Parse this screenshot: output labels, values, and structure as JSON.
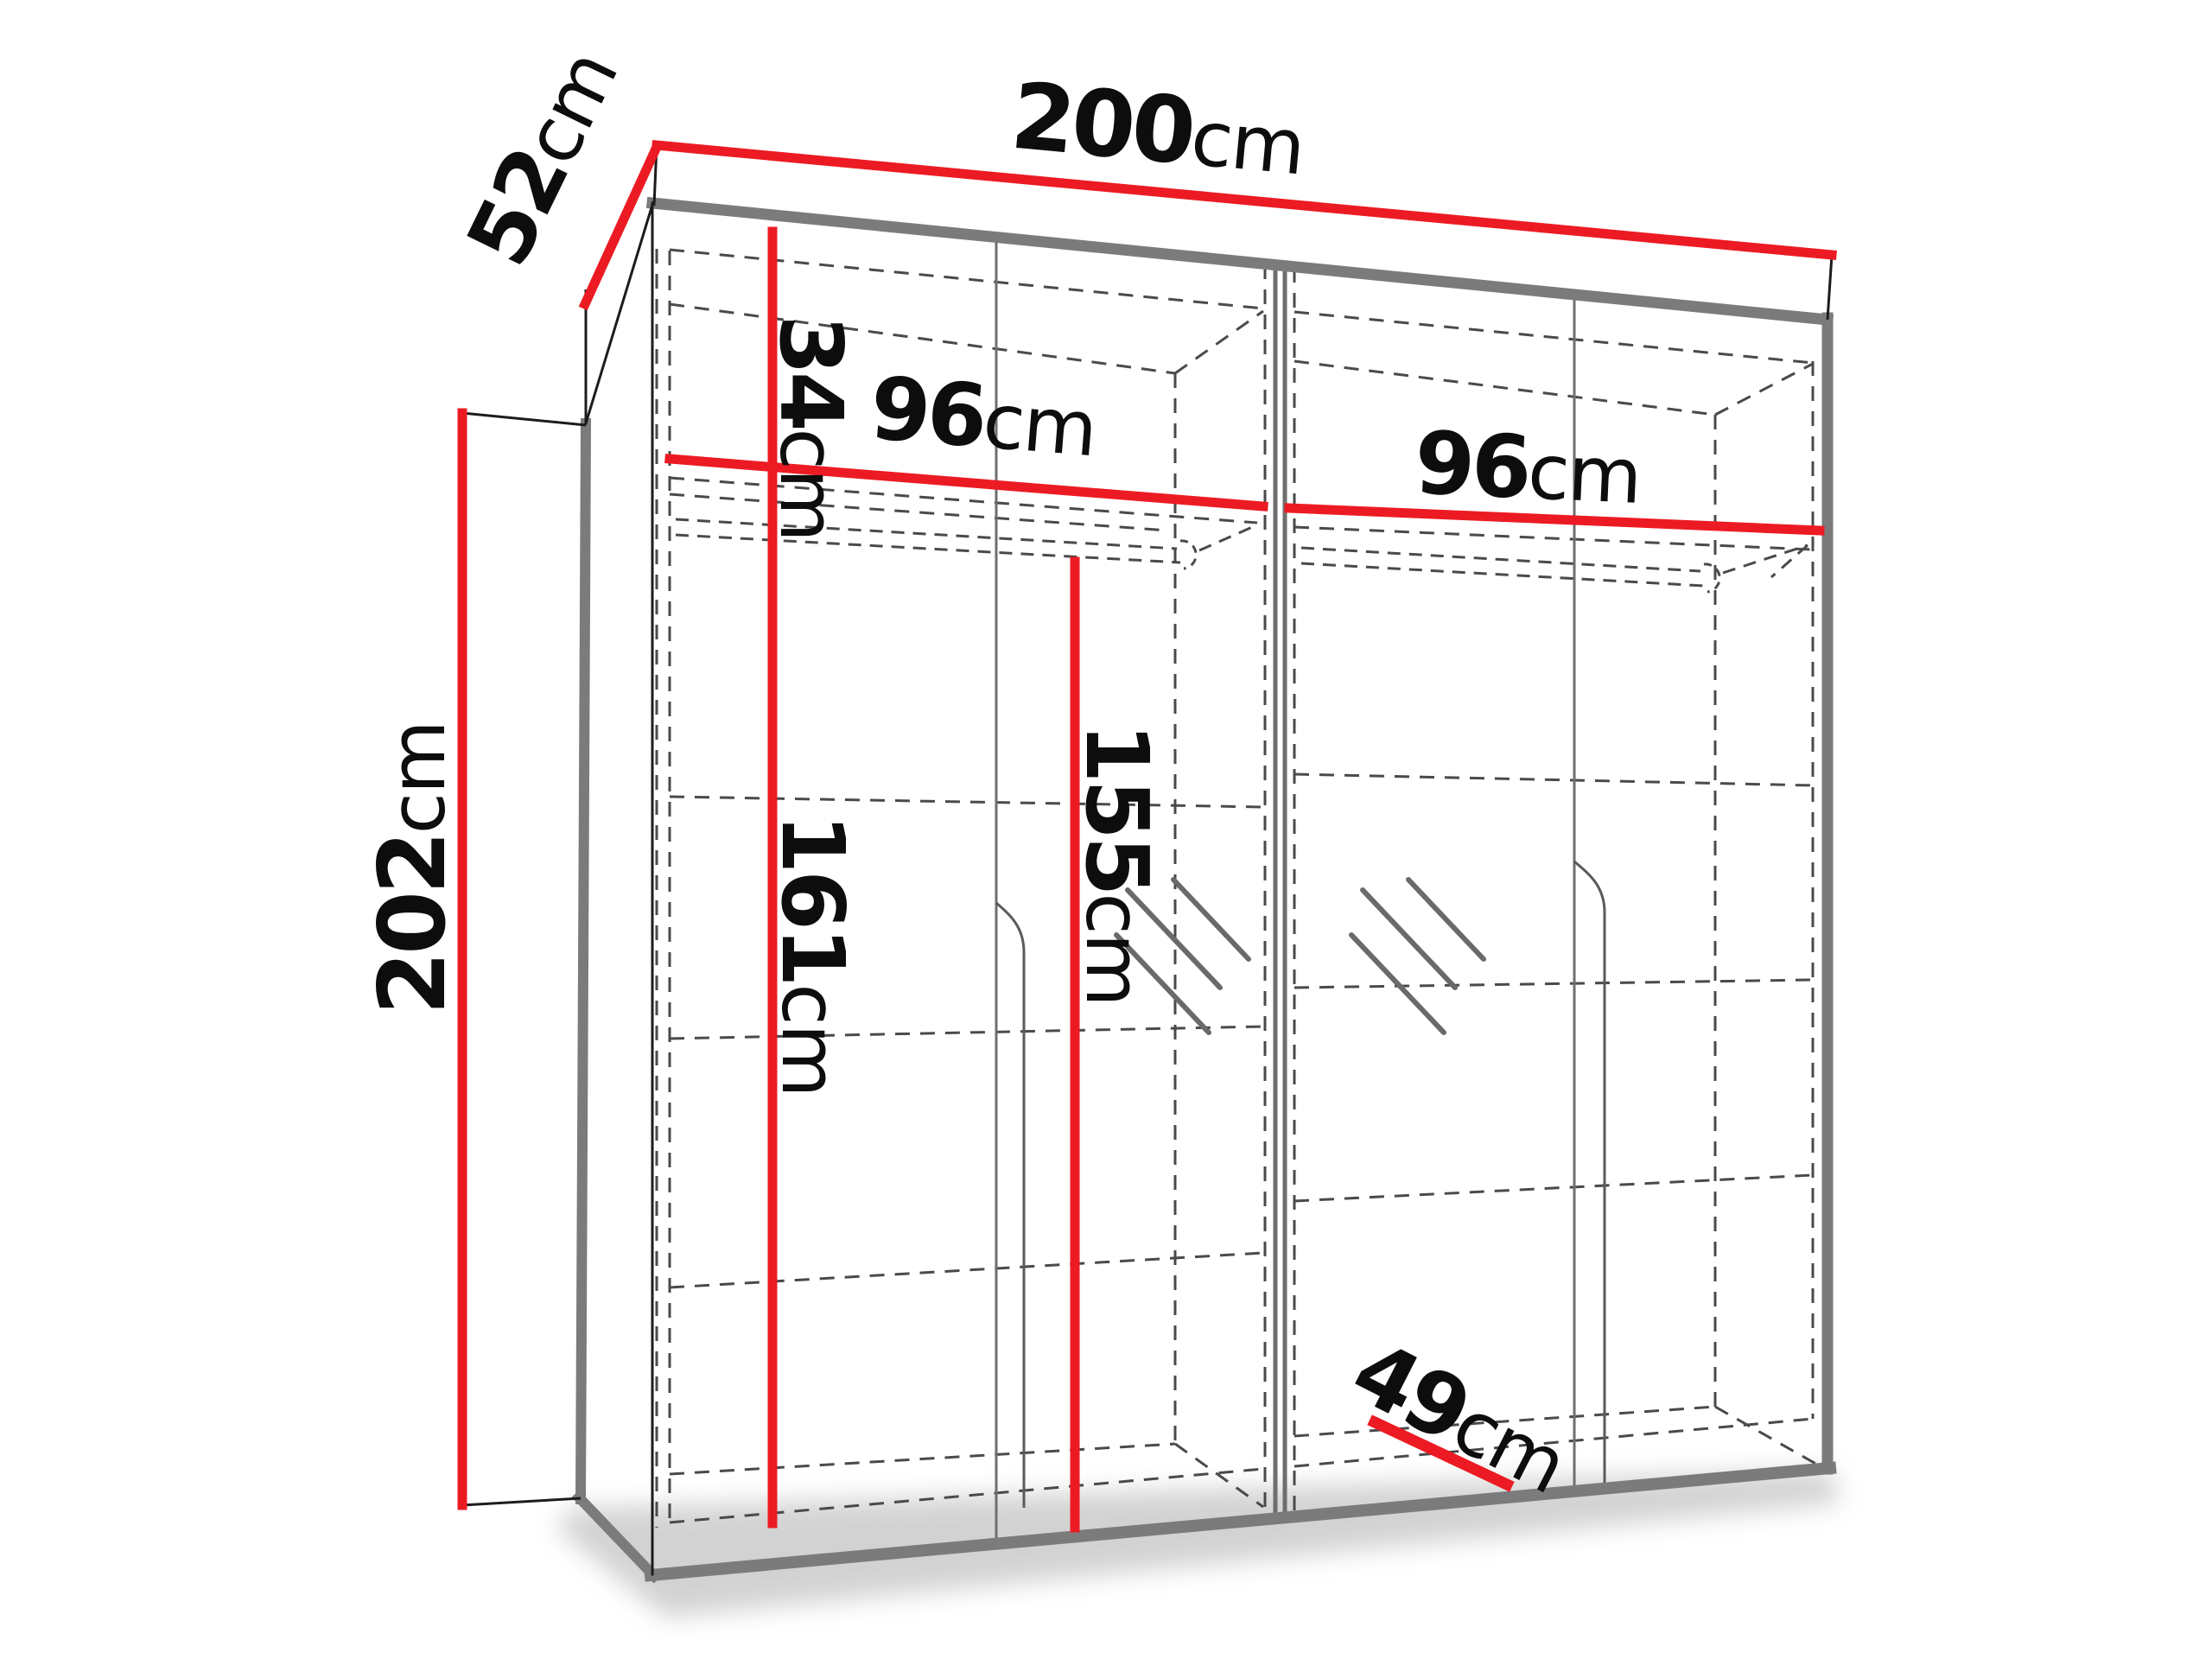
{
  "diagram": {
    "type": "wardrobe-dimension-diagram",
    "unit": "cm",
    "colors": {
      "dimension_line": "#ec1b23",
      "edge_gray": "#7b7b7b",
      "dash_gray": "#4a4a4a",
      "text": "#0d0d0d",
      "background": "#ffffff"
    },
    "dimensions": {
      "width": {
        "value": "200",
        "unit": "cm"
      },
      "depth": {
        "value": "52",
        "unit": "cm"
      },
      "height": {
        "value": "202",
        "unit": "cm"
      },
      "top_compartment": {
        "value": "34",
        "unit": "cm"
      },
      "left_section_width": {
        "value": "96",
        "unit": "cm"
      },
      "right_section_width": {
        "value": "96",
        "unit": "cm"
      },
      "lower_interior_height": {
        "value": "161",
        "unit": "cm"
      },
      "hanging_rail_height": {
        "value": "155",
        "unit": "cm"
      },
      "interior_depth": {
        "value": "49",
        "unit": "cm"
      }
    }
  }
}
